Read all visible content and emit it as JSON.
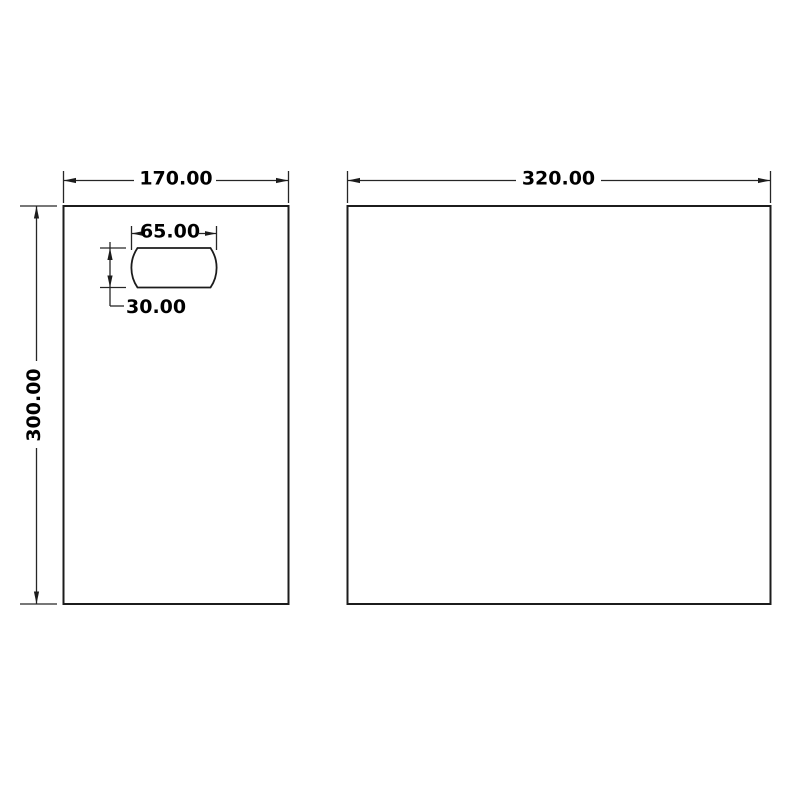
{
  "page": {
    "background_color": "#ffffff",
    "line_color": "#1c1c1c",
    "text_color": "#000000",
    "drawing_type": "dimensioned panel drawing"
  },
  "drawing": {
    "left_panel": {
      "width_label": "170.00",
      "height_label": "300.00",
      "slot": {
        "width_label": "65.00",
        "height_label": "30.00"
      }
    },
    "right_panel": {
      "width_label": "320.00"
    }
  }
}
